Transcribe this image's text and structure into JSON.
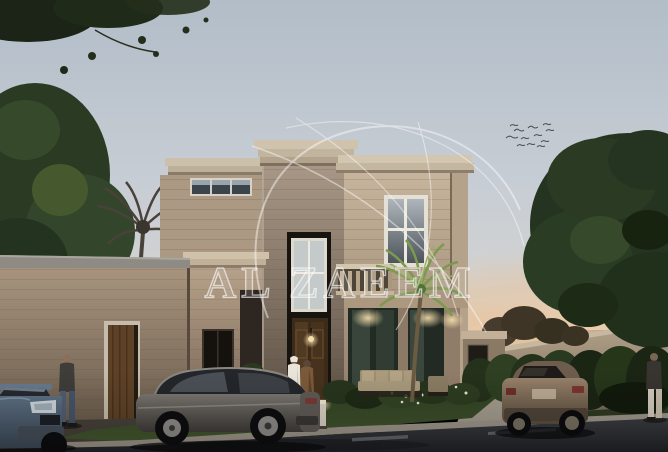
{
  "window": {
    "width": 668,
    "height": 452
  },
  "image": {
    "kind": "3d-architectural-exterior-render",
    "subject": "Beige modern-classic villa at dusk with front garden, boundary wall, parked cars and pedestrians",
    "time_of_day": "dusk"
  },
  "watermark": {
    "text": "AL ZAEEM",
    "logo": "swirl-crescent-monogram"
  },
  "colors": {
    "sky_top": "#b4bfc9",
    "sky_horizon": "#d7d5d1",
    "sunset_glow": "#eac8a4",
    "villa_wall": "#c6b49c",
    "villa_trim": "#d2c6b0",
    "tower_wall": "#a89786",
    "annex_wall": "#a8947e",
    "door_wood": "#5e4227",
    "window_glass": "#3c444b",
    "warm_light": "#f3d49b",
    "foliage_dark": "#2c3c24",
    "palm_green": "#7c9a4e",
    "lawn_green": "#3c5030",
    "road_asphalt": "#35373c",
    "curb": "#9e968a",
    "sedan_gray": "#6e6a64",
    "suv_blue": "#5d7084",
    "suv_bronze": "#8d7762",
    "boundary_wall": "#b7a58c",
    "watermark_white": "#ffffff"
  }
}
